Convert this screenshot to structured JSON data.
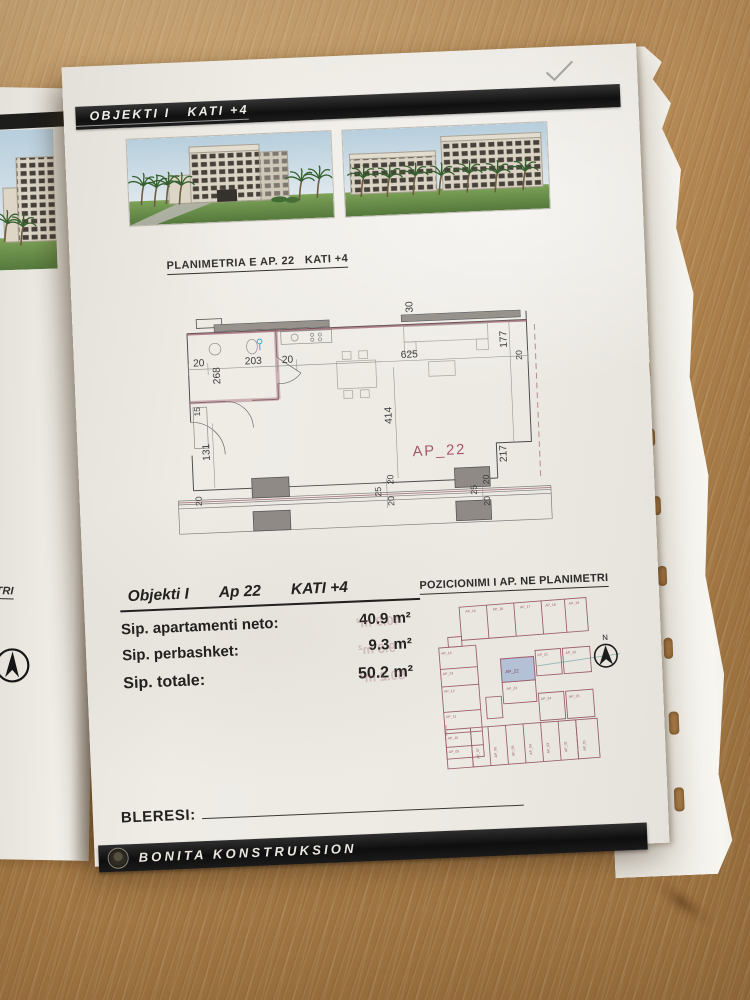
{
  "photo": {
    "checkmark_annotation": "✓"
  },
  "left_page": {
    "text_fragment": "TRI"
  },
  "page": {
    "header": {
      "title": "OBJEKTI I   KATI +4"
    },
    "plan_title": "PLANIMETRIA E AP. 22   KATI +4",
    "floor_plan": {
      "apartment_label": "AP_22",
      "dims": [
        "20",
        "268",
        "203",
        "20",
        "625",
        "30",
        "177",
        "20",
        "414",
        "217",
        "15",
        "131",
        "25",
        "20",
        "20",
        "25",
        "20",
        "20",
        "20"
      ]
    },
    "info": {
      "objekti": "Objekti I",
      "apartment": "Ap 22",
      "floor": "KATI +4",
      "rows": [
        {
          "label": "Sip. apartamenti neto:",
          "value": "40.9 m²"
        },
        {
          "label": "Sip. perbashket:",
          "value": "9.3 m²"
        },
        {
          "label": "Sip. totale:",
          "value": "50.2 m²"
        }
      ]
    },
    "position_plan": {
      "title": "POZICIONIMI I AP. NE PLANIMETRI",
      "north_label": "N",
      "highlighted_unit": "AP_22",
      "units": [
        "AP_15",
        "AP_16",
        "AP_17",
        "AP_18",
        "AP_19",
        "AP_14",
        "AP_13",
        "AP_12",
        "AP_11",
        "AP_10",
        "AP_09",
        "AP_08",
        "AP_21",
        "AP_20",
        "AP_23",
        "AP_24",
        "AP_25",
        "AP_07",
        "AP_06",
        "AP_05",
        "AP_04",
        "AP_03",
        "AP_02",
        "AP_01"
      ],
      "ghost_print": [
        "40.9 m²",
        "9.3 m²",
        "50.2 m²"
      ]
    },
    "buyer_label": "BLERESI:",
    "footer": {
      "company": "BONITA KONSTRUKSION"
    }
  }
}
